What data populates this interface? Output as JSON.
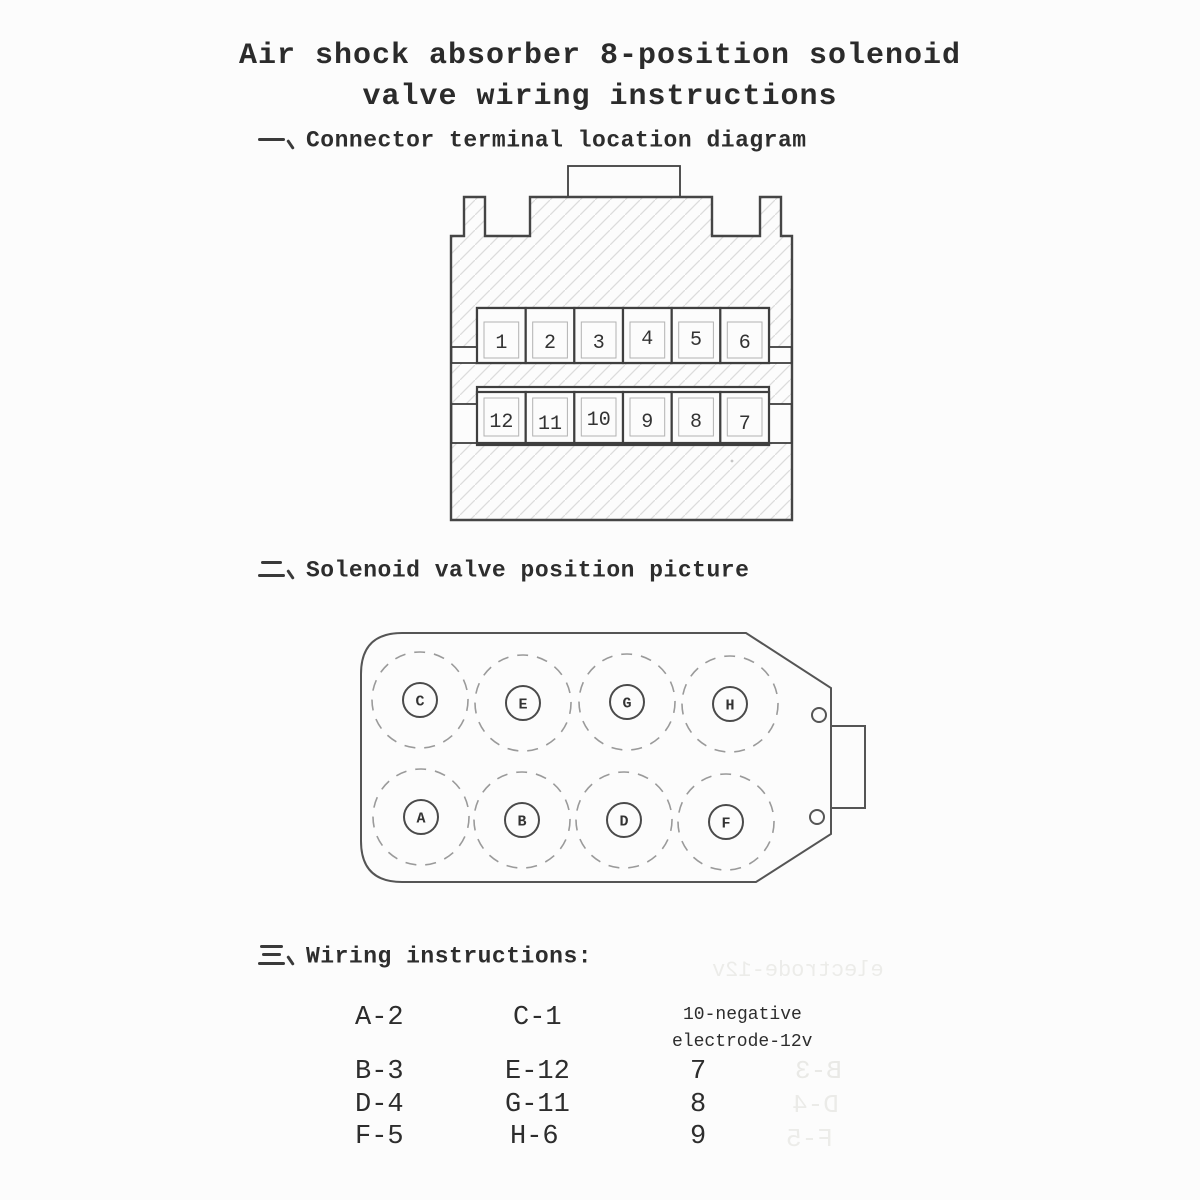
{
  "title": {
    "line1": "Air shock absorber 8-position solenoid",
    "line2": "valve wiring instructions"
  },
  "sections": [
    {
      "marker": "一、",
      "label": "Connector terminal location diagram"
    },
    {
      "marker": "二、",
      "label": "Solenoid valve position picture"
    },
    {
      "marker": "三、",
      "label": "Wiring instructions:"
    }
  ],
  "connector_diagram": {
    "top_row_terminals": [
      "1",
      "2",
      "3",
      "4",
      "5",
      "6"
    ],
    "bottom_row_terminals": [
      "12",
      "11",
      "10",
      "9",
      "8",
      "7"
    ]
  },
  "valve_diagram": {
    "top_row_valves": [
      "C",
      "E",
      "G",
      "H"
    ],
    "bottom_row_valves": [
      "A",
      "B",
      "D",
      "F"
    ]
  },
  "wiring_instructions": {
    "column1": [
      "A-2",
      "B-3",
      "D-4",
      "F-5"
    ],
    "column2": [
      "C-1",
      "E-12",
      "G-11",
      "H-6"
    ],
    "column3_header_line1": "10-negative",
    "column3_header_line2": "electrode-12v",
    "column3": [
      "7",
      "8",
      "9"
    ]
  },
  "bleedthrough": {
    "items": [
      {
        "text": "electrode-12v"
      },
      {
        "text": "B-3"
      },
      {
        "text": "D-4"
      },
      {
        "text": "F-5"
      }
    ]
  },
  "colors": {
    "ink": "#2e2e2e",
    "line": "#454545",
    "hatch": "#dcdcdc",
    "paper": "#fcfcfc"
  }
}
